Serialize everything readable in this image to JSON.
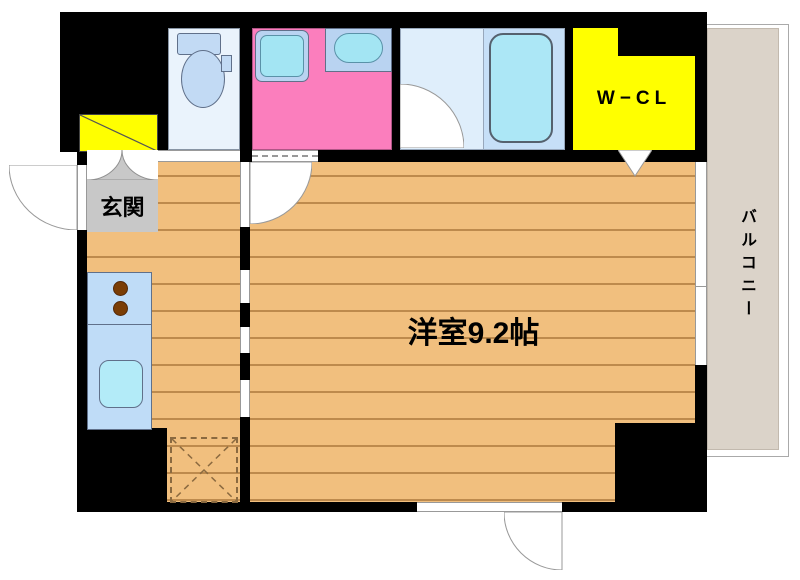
{
  "plan": {
    "rooms": {
      "genkan": {
        "label": "玄関"
      },
      "main_room": {
        "label": "洋室9.2帖"
      },
      "walk_in_closet": {
        "label": "W−CL"
      },
      "balcony": {
        "label": "バルコニー"
      }
    },
    "colors": {
      "wall": "#000000",
      "floor": "#F1BF7E",
      "floor_line": "#925F24",
      "washroom_pink": "#FB7EBD",
      "closet_yellow": "#FFFF00",
      "genkan_gray": "#C8C8C8",
      "balcony_beige": "#DBD3C9",
      "fixture_blue": "#BFDCF7",
      "fixture_cyan": "#ACE7F6",
      "bathroom_light_blue": "#DFEEFB",
      "bathtub_area_blue": "#C6DFF7",
      "toilet_room_blue": "#EAF3FC"
    }
  }
}
